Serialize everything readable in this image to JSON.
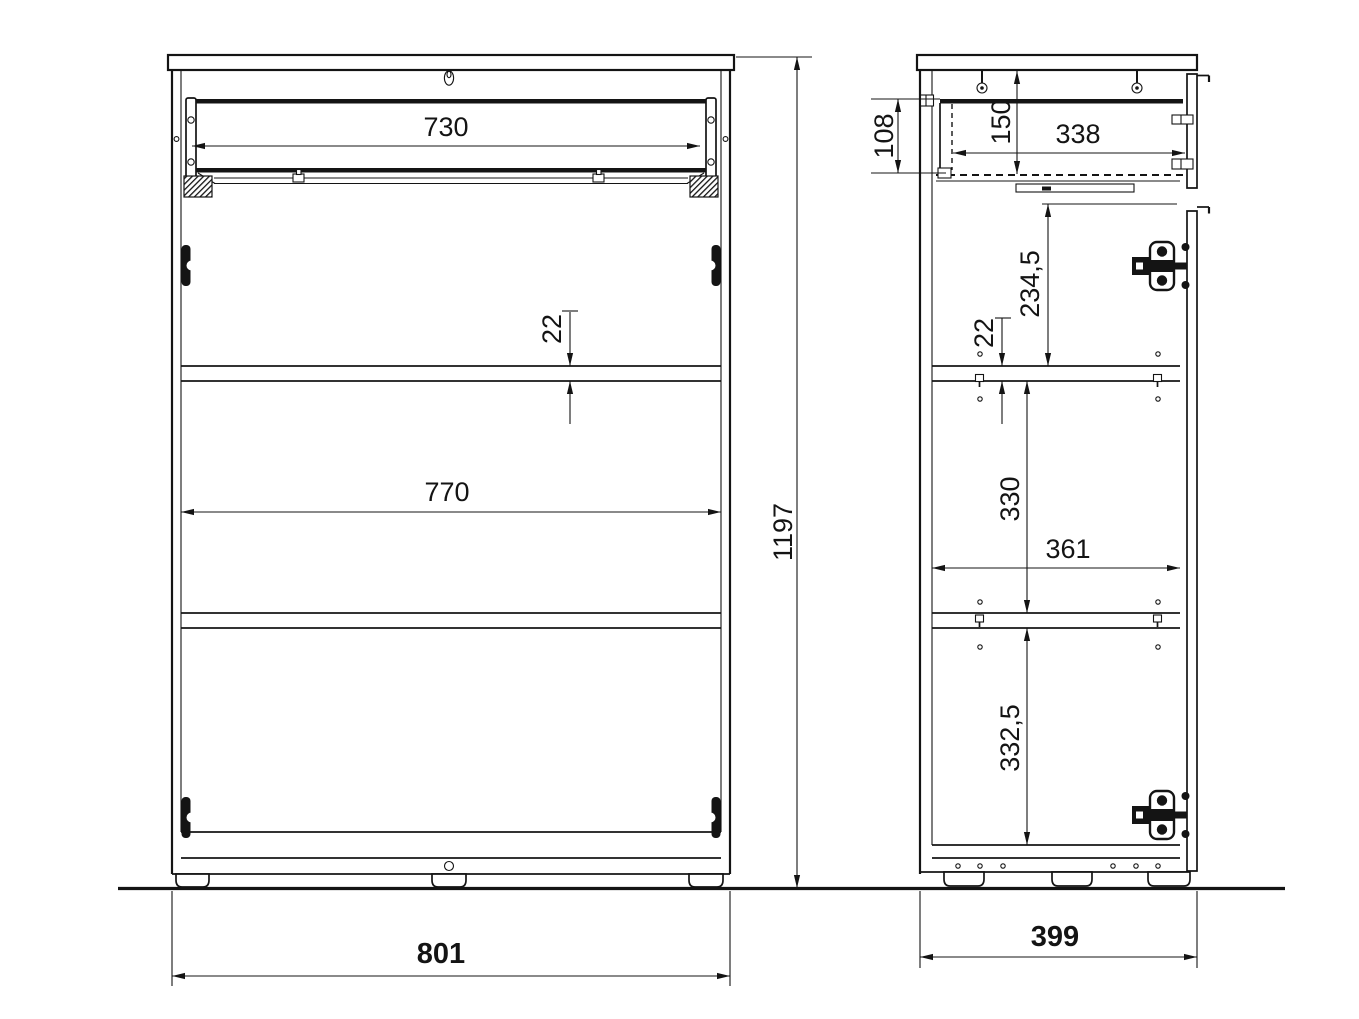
{
  "drawing": {
    "type": "furniture-technical-drawing",
    "description": "Cabinet with top drawer, door and two shelves - front section and side section views with millimetre dimensions",
    "colors": {
      "line": "#141414",
      "background": "#ffffff"
    }
  },
  "views": {
    "front": {
      "name": "front-section-view",
      "dims": {
        "drawer_width": "730",
        "shelf_thickness": "22",
        "interior_width": "770",
        "overall_height": "1197",
        "overall_width": "801"
      }
    },
    "side": {
      "name": "side-section-view",
      "dims": {
        "drawer_side_height": "108",
        "drawer_front_inner_height": "150",
        "drawer_inner_depth": "338",
        "top_section_height": "234,5",
        "shelf_thickness": "22",
        "middle_section_height": "330",
        "interior_depth": "361",
        "bottom_section_height": "332,5",
        "overall_depth": "399"
      }
    }
  }
}
